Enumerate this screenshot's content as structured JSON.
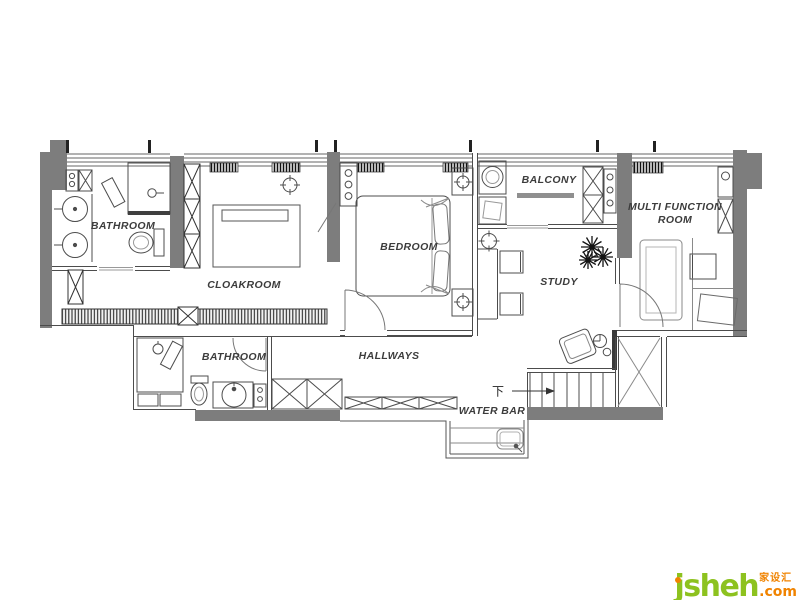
{
  "canvas": {
    "width": 800,
    "height": 600,
    "background": "#ffffff"
  },
  "colors": {
    "wall_fill": "#7d7d7d",
    "line_dark": "#4c4c4c",
    "line_light": "#8a8a8a",
    "label_text": "#3c3c3c",
    "logo_green": "#8dc21f",
    "logo_orange": "#f08300"
  },
  "rooms": [
    {
      "id": "bathroom-1",
      "label": "BATHROOM"
    },
    {
      "id": "cloakroom",
      "label": "CLOAKROOM"
    },
    {
      "id": "bedroom",
      "label": "BEDROOM"
    },
    {
      "id": "balcony",
      "label": "BALCONY"
    },
    {
      "id": "multi-function-room",
      "label": "MULTI FUNCTION ROOM"
    },
    {
      "id": "study",
      "label": "STUDY"
    },
    {
      "id": "bathroom-2",
      "label": "BATHROOM"
    },
    {
      "id": "hallways",
      "label": "HALLWAYS"
    },
    {
      "id": "water-bar",
      "label": "WATER BAR"
    }
  ],
  "annotations": {
    "stairs_direction": "下"
  },
  "watermark": {
    "brand_initial": "j",
    "brand_rest": "sheh",
    "tld": ".com",
    "cjk_name": "家设汇"
  }
}
